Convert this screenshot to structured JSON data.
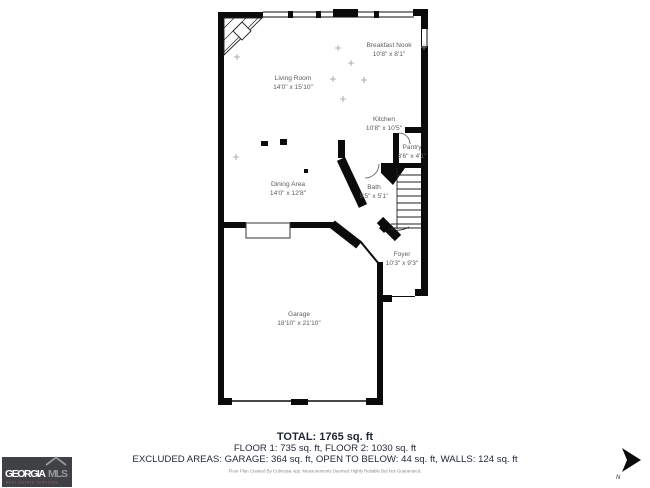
{
  "page": {
    "background": "#ffffff"
  },
  "floor_plan": {
    "rooms": [
      {
        "id": "breakfast-nook",
        "name": "Breakfast Nook",
        "dims": "10'8\" x 8'1\""
      },
      {
        "id": "living-room",
        "name": "Living Room",
        "dims": "14'0\" x 15'10\""
      },
      {
        "id": "kitchen",
        "name": "Kitchen",
        "dims": "10'8\" x 10'5\""
      },
      {
        "id": "pantry",
        "name": "Pantry",
        "dims": "3'6\" x 4'1\""
      },
      {
        "id": "dining-area",
        "name": "Dining Area",
        "dims": "14'0\" x 12'8\""
      },
      {
        "id": "bath",
        "name": "Bath",
        "dims": "5'5\" x 5'1\""
      },
      {
        "id": "foyer",
        "name": "Foyer",
        "dims": "10'3\" x 9'3\""
      },
      {
        "id": "garage",
        "name": "Garage",
        "dims": "18'10\" x 21'10\""
      }
    ]
  },
  "summary": {
    "total": "TOTAL: 1765 sq. ft",
    "floors": "FLOOR 1: 735 sq. ft, FLOOR 2: 1030 sq. ft",
    "excluded": "EXCLUDED AREAS: GARAGE: 364 sq. ft, OPEN TO BELOW: 44 sq. ft, WALLS: 124 sq. ft",
    "disclaimer": "Floor Plan Created By Cubicasa App. Measurements Deemed Highly Reliable But Not Guaranteed."
  },
  "branding": {
    "logo_primary": "GEORGIA",
    "logo_secondary": "MLS",
    "logo_tagline": "REAL ESTATE SERVICES",
    "logo_bg": "#404145"
  },
  "compass": {
    "label": "N"
  }
}
